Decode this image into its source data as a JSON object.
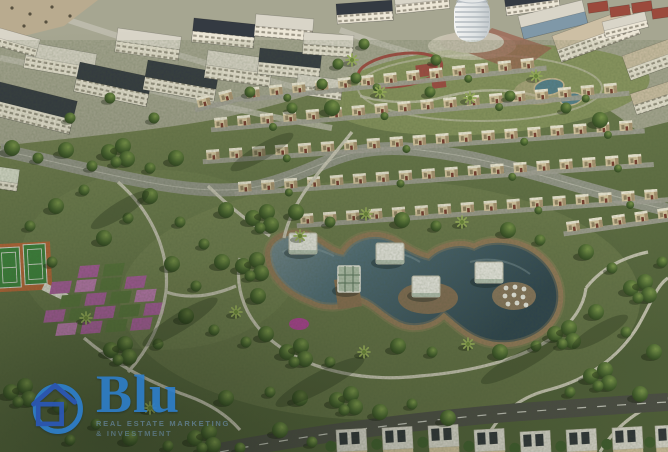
{
  "meta": {
    "type": "aerial-render",
    "description": "Aerial 3D rendering of a master-planned residential community: apartment blocks and a high-rise tower at top, curved rows of villas, a large landscaped park with a multi-lobed lagoon, floating pavilions, tennis courts and a pink flower-bed grid"
  },
  "watermark": {
    "brand": "Blu",
    "tagline_line1": "REAL ESTATE MARKETING",
    "tagline_line2": "& INVESTMENT"
  },
  "scene": {
    "landmarks": [
      {
        "label": "apartment blocks"
      },
      {
        "label": "high-rise tower"
      },
      {
        "label": "villa rows"
      },
      {
        "label": "central lagoon"
      },
      {
        "label": "lake pavilions"
      },
      {
        "label": "umbrella seating"
      },
      {
        "label": "tennis courts"
      },
      {
        "label": "flower garden grid"
      },
      {
        "label": "jogging track"
      },
      {
        "label": "twin ponds"
      },
      {
        "label": "winding park paths"
      },
      {
        "label": "perimeter road"
      }
    ]
  },
  "theme": {
    "logo_blue": "#2d7ecb",
    "logo_house_blue": "#2a57b8",
    "grass": "#6b7a4c",
    "grass_light": "#82895a",
    "grass_dark": "#4f5e38",
    "tree_dark": "#243618",
    "water": "#36505c",
    "water_light": "#7b8f96",
    "shore": "#8f7355",
    "road": "#9c9c94",
    "asphalt": "#4b4c45",
    "path": "#d6d1c2",
    "bldg_wall": "#ece6d6",
    "bldg_shadow": "#b3a996",
    "roof_dark": "#343a42",
    "roof_red": "#9b4a3c",
    "villa_wall": "#ddcba6",
    "villa_accent": "#7a3b2f",
    "court_green": "#3f8a3f",
    "court_orange": "#c06a3a",
    "flower_pink": "#b361a6",
    "flower_pink_light": "#c77fba",
    "flower_green": "#5d7a3f",
    "track_red": "#a04a42",
    "pond_blue": "#54808e",
    "sand": "#b9ab8f",
    "pavilion_white": "#f2f1ea"
  }
}
